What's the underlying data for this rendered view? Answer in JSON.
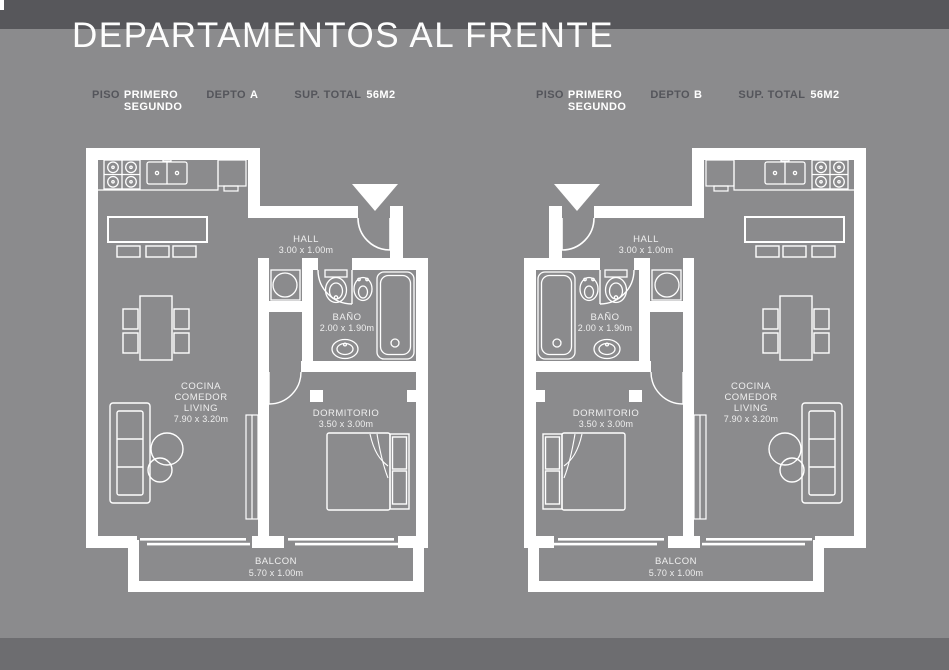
{
  "title": "DEPARTAMENTOS AL FRENTE",
  "colors": {
    "background": "#8b8b8d",
    "band_top": "#57575b",
    "band_bottom": "#6d6d70",
    "plan_lines": "#ffffff",
    "muted_label": "#54555b",
    "value_text": "#ffffff"
  },
  "apartments": [
    {
      "letter": "A",
      "header": {
        "piso_label": "PISO",
        "piso_line1": "PRIMERO",
        "piso_line2": "SEGUNDO",
        "depto_label": "DEPTO",
        "depto_value": "A",
        "sup_label": "SUP. TOTAL",
        "sup_value": "56M2"
      },
      "rooms": {
        "hall_name": "HALL",
        "hall_dims": "3.00 x 1.00m",
        "bano_name": "BAÑO",
        "bano_dims": "2.00 x 1.90m",
        "living_line1": "COCINA",
        "living_line2": "COMEDOR",
        "living_line3": "LIVING",
        "living_dims": "7.90 x 3.20m",
        "dorm_name": "DORMITORIO",
        "dorm_dims": "3.50 x 3.00m",
        "balcon_name": "BALCON",
        "balcon_dims": "5.70 x 1.00m"
      }
    },
    {
      "letter": "B",
      "header": {
        "piso_label": "PISO",
        "piso_line1": "PRIMERO",
        "piso_line2": "SEGUNDO",
        "depto_label": "DEPTO",
        "depto_value": "B",
        "sup_label": "SUP. TOTAL",
        "sup_value": "56M2"
      },
      "rooms": {
        "hall_name": "HALL",
        "hall_dims": "3.00 x 1.00m",
        "bano_name": "BAÑO",
        "bano_dims": "2.00 x 1.90m",
        "living_line1": "COCINA",
        "living_line2": "COMEDOR",
        "living_line3": "LIVING",
        "living_dims": "7.90 x 3.20m",
        "dorm_name": "DORMITORIO",
        "dorm_dims": "3.50 x 3.00m",
        "balcon_name": "BALCON",
        "balcon_dims": "5.70 x 1.00m"
      }
    }
  ]
}
